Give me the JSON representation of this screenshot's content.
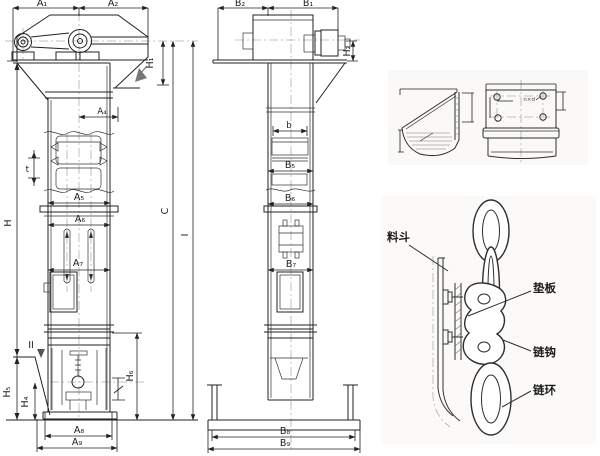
{
  "drawing": {
    "front_view": {
      "a1": "A₁",
      "a2": "A₂",
      "a4": "A₄",
      "a5": "A₅",
      "a6": "A₆",
      "a7": "A₇",
      "a8": "A₈",
      "a9": "A₉",
      "h": "H",
      "h1": "H₁",
      "h4": "H₄",
      "h5": "H₅",
      "h6": "H₆",
      "t": "t",
      "section_mark": "II"
    },
    "side_view": {
      "b1": "B₁",
      "b2": "B₂",
      "b": "b",
      "b5": "B₅",
      "b6": "B₆",
      "b7": "B₇",
      "b8": "B₈",
      "b9": "B₉",
      "h2": "H₂"
    },
    "shared_dims": {
      "c": "C",
      "i": "I"
    },
    "bucket_detail": {
      "holes_note": "n×d"
    },
    "chain_detail": {
      "bucket_label": "料斗",
      "pad_label": "垫板",
      "hook_label": "链钩",
      "ring_label": "链环"
    },
    "colors": {
      "line": "#222222",
      "centerline": "#b0b0b0",
      "arrow_accent": "#777777",
      "background": "#ffffff"
    }
  }
}
